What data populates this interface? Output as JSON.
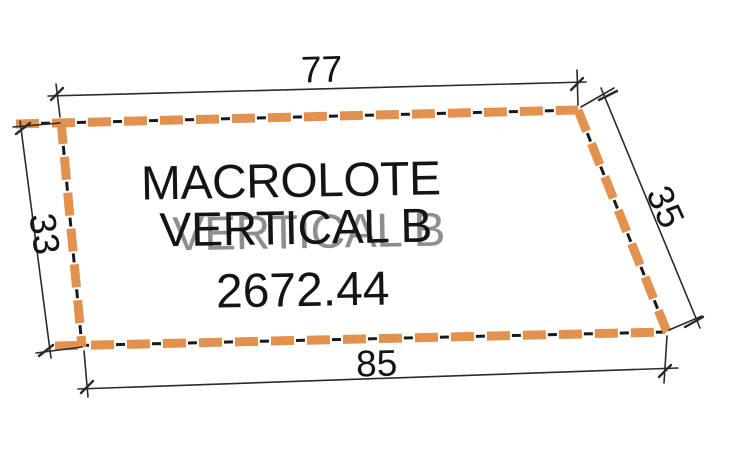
{
  "diagram": {
    "parcel_name_line1": "MACROLOTE",
    "parcel_name_line2": "VERTICAL B",
    "area": "2672.44",
    "dimensions": {
      "top": "77",
      "right": "35",
      "bottom": "85",
      "left": "33"
    },
    "colors": {
      "boundary_orange": "#E2914E",
      "boundary_black": "#1A1A1A",
      "dimension_line": "#2B2B2B",
      "text": "#141414",
      "ghost_text": "#8E8E8E",
      "background": "#FFFFFF"
    }
  }
}
